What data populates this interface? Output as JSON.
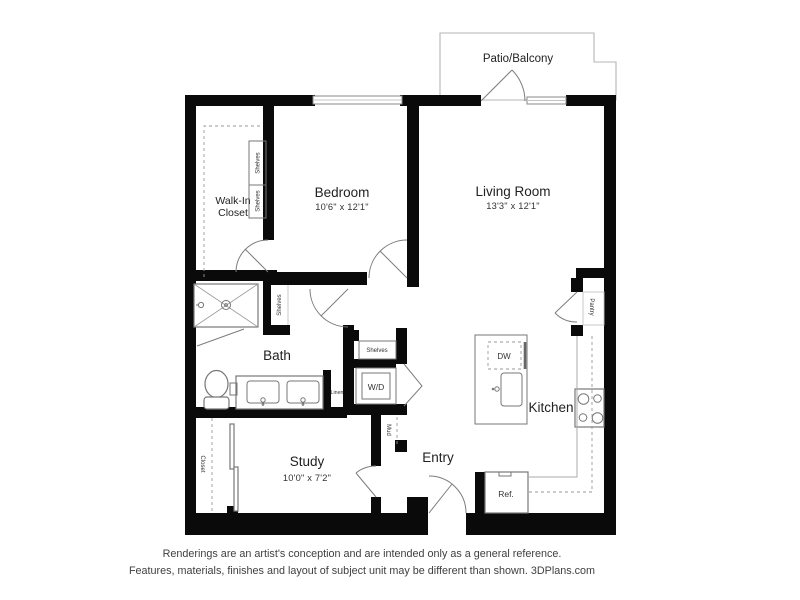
{
  "colors": {
    "wall": "#0a0a0a",
    "fixture": "#777777",
    "thin": "#ababab",
    "dash": "#9a9a9a",
    "ink": "#222222",
    "patio_outline": "#b5b5b5"
  },
  "patio": {
    "label": "Patio/Balcony"
  },
  "rooms": {
    "bedroom": {
      "label": "Bedroom",
      "dims": "10'6\" x 12'1\""
    },
    "living_room": {
      "label": "Living Room",
      "dims": "13'3\" x 12'1\""
    },
    "walk_in_closet": {
      "label_line1": "Walk-In",
      "label_line2": "Closet"
    },
    "bath": {
      "label": "Bath"
    },
    "study": {
      "label": "Study",
      "dims": "10'0\" x 7'2\""
    },
    "entry": {
      "label": "Entry"
    },
    "kitchen": {
      "label": "Kitchen"
    }
  },
  "features": {
    "shelves_closet_upper": "Shelves",
    "shelves_closet_lower": "Shelves",
    "shelves_bath": "Shelves",
    "shelves_hall": "Shelves",
    "linen": "Linen",
    "wd": "W/D",
    "mud": "Mud",
    "closet_study": "Closet",
    "pantry": "Pantry",
    "dw": "DW",
    "ref": "Ref."
  },
  "disclaimer": {
    "line1": "Renderings are an artist's conception and are intended only as a general reference.",
    "line2": "Features, materials, finishes and layout of subject unit may be different than shown. 3DPlans.com"
  }
}
